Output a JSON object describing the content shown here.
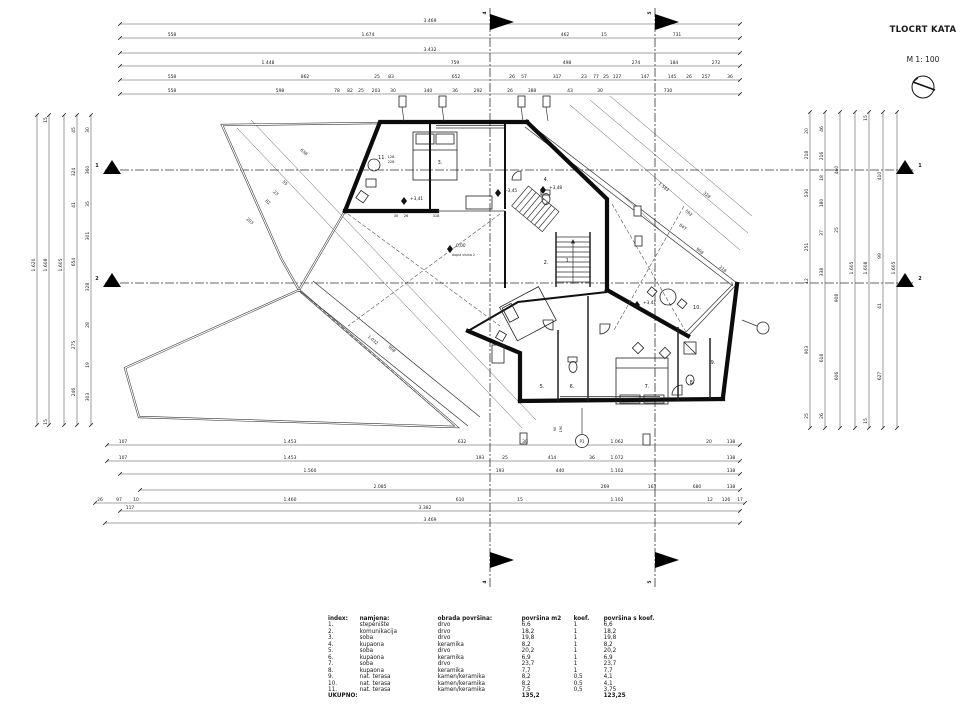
{
  "title_block": {
    "title": "TLOCRT KATA",
    "scale_label": "M 1: 100"
  },
  "sections": {
    "vertical": [
      {
        "label": "4",
        "x": 490
      },
      {
        "label": "5",
        "x": 655
      }
    ],
    "horizontal": [
      {
        "label": "1",
        "y": 170
      },
      {
        "label": "2",
        "y": 283
      }
    ]
  },
  "plan": {
    "room_labels": [
      {
        "t": "1.",
        "x": 568,
        "y": 262
      },
      {
        "t": "2.",
        "x": 546,
        "y": 264
      },
      {
        "t": "3.",
        "x": 440,
        "y": 164
      },
      {
        "t": "4.",
        "x": 546,
        "y": 181
      },
      {
        "t": "5.",
        "x": 542,
        "y": 388
      },
      {
        "t": "6.",
        "x": 572,
        "y": 388
      },
      {
        "t": "7.",
        "x": 647,
        "y": 388
      },
      {
        "t": "8.",
        "x": 692,
        "y": 384
      },
      {
        "t": "9.",
        "x": 713,
        "y": 364
      },
      {
        "t": "10.",
        "x": 697,
        "y": 309
      },
      {
        "t": "11.",
        "x": 382,
        "y": 159
      }
    ],
    "elevations": [
      {
        "t": "0,00",
        "x": 456,
        "y": 247,
        "dx": 450,
        "dy": 249
      },
      {
        "t": "+3,41",
        "x": 410,
        "y": 200,
        "dx": 404,
        "dy": 201
      },
      {
        "t": "+3,45",
        "x": 504,
        "y": 192,
        "dx": 498,
        "dy": 193
      },
      {
        "t": "+3,48",
        "x": 549,
        "y": 189,
        "dx": 543,
        "dy": 190
      },
      {
        "t": "+3,41",
        "x": 643,
        "y": 304,
        "dx": 637,
        "dy": 305
      }
    ],
    "notes": [
      {
        "t": "dupla visina 2",
        "x": 452,
        "y": 256
      }
    ],
    "tags": [
      {
        "t": "P1",
        "x": 582,
        "y": 443
      }
    ],
    "inline_dims": [
      {
        "t": "30",
        "x": 396,
        "y": 217
      },
      {
        "t": "26",
        "x": 406,
        "y": 217
      },
      {
        "t": "318",
        "x": 436,
        "y": 217
      },
      {
        "t": "128",
        "x": 391,
        "y": 158
      },
      {
        "t": "228",
        "x": 391,
        "y": 163
      },
      {
        "t": "90",
        "x": 556,
        "y": 429,
        "r": -90
      },
      {
        "t": "190",
        "x": 562,
        "y": 429,
        "r": -90
      }
    ]
  },
  "dimensions": {
    "top": [
      {
        "y": 24,
        "labels": [
          {
            "t": "3.469",
            "x": 430
          }
        ]
      },
      {
        "y": 38,
        "labels": [
          {
            "t": "558",
            "x": 172
          },
          {
            "t": "1.674",
            "x": 368
          },
          {
            "t": "462",
            "x": 565
          },
          {
            "t": "15",
            "x": 604
          },
          {
            "t": "731",
            "x": 677
          }
        ]
      },
      {
        "y": 53,
        "labels": [
          {
            "t": "3.432",
            "x": 430
          }
        ]
      },
      {
        "y": 66,
        "labels": [
          {
            "t": "1.448",
            "x": 268
          },
          {
            "t": "759",
            "x": 455
          },
          {
            "t": "498",
            "x": 567
          },
          {
            "t": "274",
            "x": 636
          },
          {
            "t": "184",
            "x": 674
          },
          {
            "t": "272",
            "x": 716
          }
        ]
      },
      {
        "y": 80,
        "labels": [
          {
            "t": "558",
            "x": 172
          },
          {
            "t": "862",
            "x": 305
          },
          {
            "t": "25",
            "x": 377
          },
          {
            "t": "83",
            "x": 391
          },
          {
            "t": "652",
            "x": 456
          },
          {
            "t": "26",
            "x": 512
          },
          {
            "t": "57",
            "x": 524
          },
          {
            "t": "317",
            "x": 557
          },
          {
            "t": "23",
            "x": 584
          },
          {
            "t": "77",
            "x": 596
          },
          {
            "t": "25",
            "x": 606
          },
          {
            "t": "127",
            "x": 617
          },
          {
            "t": "147",
            "x": 645
          },
          {
            "t": "145",
            "x": 672
          },
          {
            "t": "26",
            "x": 689
          },
          {
            "t": "257",
            "x": 706
          },
          {
            "t": "36",
            "x": 730
          }
        ]
      },
      {
        "y": 94,
        "labels": [
          {
            "t": "558",
            "x": 172
          },
          {
            "t": "598",
            "x": 280
          },
          {
            "t": "78",
            "x": 337
          },
          {
            "t": "82",
            "x": 350
          },
          {
            "t": "25",
            "x": 361
          },
          {
            "t": "203",
            "x": 376
          },
          {
            "t": "30",
            "x": 393
          },
          {
            "t": "340",
            "x": 428
          },
          {
            "t": "36",
            "x": 455
          },
          {
            "t": "292",
            "x": 478
          },
          {
            "t": "26",
            "x": 510
          },
          {
            "t": "388",
            "x": 532
          },
          {
            "t": "43",
            "x": 570
          },
          {
            "t": "30",
            "x": 600
          },
          {
            "t": "730",
            "x": 668
          }
        ]
      }
    ],
    "bottom": [
      {
        "y": 445,
        "labels": [
          {
            "t": "107",
            "x": 123
          },
          {
            "t": "1.453",
            "x": 290
          },
          {
            "t": "632",
            "x": 462
          },
          {
            "t": "30",
            "x": 525
          },
          {
            "t": "1.062",
            "x": 617
          },
          {
            "t": "20",
            "x": 709
          },
          {
            "t": "138",
            "x": 731
          }
        ]
      },
      {
        "y": 461,
        "labels": [
          {
            "t": "107",
            "x": 123
          },
          {
            "t": "1.453",
            "x": 290
          },
          {
            "t": "193",
            "x": 480
          },
          {
            "t": "25",
            "x": 505
          },
          {
            "t": "414",
            "x": 552
          },
          {
            "t": "36",
            "x": 592
          },
          {
            "t": "1.072",
            "x": 617
          },
          {
            "t": "138",
            "x": 731
          }
        ]
      },
      {
        "y": 474,
        "labels": [
          {
            "t": "1.560",
            "x": 310
          },
          {
            "t": "193",
            "x": 500
          },
          {
            "t": "440",
            "x": 560
          },
          {
            "t": "1.102",
            "x": 617
          },
          {
            "t": "138",
            "x": 731
          }
        ]
      },
      {
        "y": 490,
        "labels": [
          {
            "t": "2.085",
            "x": 380
          },
          {
            "t": "269",
            "x": 605
          },
          {
            "t": "163",
            "x": 652
          },
          {
            "t": "680",
            "x": 697
          },
          {
            "t": "138",
            "x": 731
          }
        ]
      },
      {
        "y": 503,
        "labels": [
          {
            "t": "26",
            "x": 100
          },
          {
            "t": "97",
            "x": 119
          },
          {
            "t": "10",
            "x": 136
          },
          {
            "t": "1.460",
            "x": 290
          },
          {
            "t": "610",
            "x": 460
          },
          {
            "t": "15",
            "x": 520
          },
          {
            "t": "1.102",
            "x": 617
          },
          {
            "t": "12",
            "x": 710
          },
          {
            "t": "126",
            "x": 726
          },
          {
            "t": "17",
            "x": 740
          }
        ]
      },
      {
        "y": 511,
        "labels": [
          {
            "t": "117",
            "x": 130
          },
          {
            "t": "3.382",
            "x": 425
          }
        ]
      },
      {
        "y": 523,
        "labels": [
          {
            "t": "3.469",
            "x": 430
          }
        ]
      }
    ],
    "left": [
      {
        "x": 37,
        "labels": [
          {
            "t": "1.620",
            "y": 265
          }
        ]
      },
      {
        "x": 49,
        "labels": [
          {
            "t": "15",
            "y": 120
          },
          {
            "t": "1.608",
            "y": 265
          },
          {
            "t": "15",
            "y": 422
          }
        ]
      },
      {
        "x": 64,
        "labels": [
          {
            "t": "1.605",
            "y": 265
          }
        ]
      },
      {
        "x": 77,
        "labels": [
          {
            "t": "45",
            "y": 130
          },
          {
            "t": "324",
            "y": 172
          },
          {
            "t": "41",
            "y": 205
          },
          {
            "t": "654",
            "y": 262
          },
          {
            "t": "275",
            "y": 345
          },
          {
            "t": "246",
            "y": 392
          }
        ]
      },
      {
        "x": 91,
        "labels": [
          {
            "t": "30",
            "y": 130
          },
          {
            "t": "360",
            "y": 170
          },
          {
            "t": "35",
            "y": 204
          },
          {
            "t": "301",
            "y": 236
          },
          {
            "t": "328",
            "y": 287
          },
          {
            "t": "28",
            "y": 325
          },
          {
            "t": "19",
            "y": 365
          },
          {
            "t": "303",
            "y": 397
          }
        ]
      }
    ],
    "right": [
      {
        "x": 810,
        "labels": [
          {
            "t": "20",
            "y": 131
          },
          {
            "t": "218",
            "y": 155
          },
          {
            "t": "530",
            "y": 193
          },
          {
            "t": "251",
            "y": 247
          },
          {
            "t": "12",
            "y": 281
          },
          {
            "t": "903",
            "y": 350
          },
          {
            "t": "25",
            "y": 416
          }
        ]
      },
      {
        "x": 825,
        "labels": [
          {
            "t": "46",
            "y": 129
          },
          {
            "t": "216",
            "y": 156
          },
          {
            "t": "18",
            "y": 178
          },
          {
            "t": "180",
            "y": 203
          },
          {
            "t": "37",
            "y": 233
          },
          {
            "t": "338",
            "y": 272
          },
          {
            "t": "618",
            "y": 358
          },
          {
            "t": "26",
            "y": 416
          }
        ]
      },
      {
        "x": 840,
        "labels": [
          {
            "t": "460",
            "y": 170
          },
          {
            "t": "25",
            "y": 230
          },
          {
            "t": "908",
            "y": 298
          },
          {
            "t": "606",
            "y": 376
          }
        ]
      },
      {
        "x": 855,
        "labels": [
          {
            "t": "1.605",
            "y": 268
          }
        ]
      },
      {
        "x": 869,
        "labels": [
          {
            "t": "15",
            "y": 118
          },
          {
            "t": "1.608",
            "y": 268
          },
          {
            "t": "15",
            "y": 421
          }
        ]
      },
      {
        "x": 883,
        "labels": [
          {
            "t": "410",
            "y": 176
          },
          {
            "t": "99",
            "y": 256
          },
          {
            "t": "41",
            "y": 306
          },
          {
            "t": "627",
            "y": 376
          }
        ]
      },
      {
        "x": 897,
        "labels": [
          {
            "t": "1.605",
            "y": 268
          }
        ]
      }
    ],
    "diagonal": [
      {
        "t": "638",
        "x": 303,
        "y": 153,
        "r": 42
      },
      {
        "t": "55",
        "x": 284,
        "y": 184,
        "r": 42
      },
      {
        "t": "23",
        "x": 275,
        "y": 194,
        "r": 42
      },
      {
        "t": "82",
        "x": 267,
        "y": 203,
        "r": 42
      },
      {
        "t": "203",
        "x": 249,
        "y": 222,
        "r": 42
      },
      {
        "t": "1.032",
        "x": 372,
        "y": 341,
        "r": 41
      },
      {
        "t": "908",
        "x": 391,
        "y": 350,
        "r": 41
      },
      {
        "t": "1.583",
        "x": 663,
        "y": 188,
        "r": 38
      },
      {
        "t": "328",
        "x": 706,
        "y": 196,
        "r": 38
      },
      {
        "t": "562",
        "x": 688,
        "y": 214,
        "r": 38
      },
      {
        "t": "847",
        "x": 682,
        "y": 228,
        "r": 38
      },
      {
        "t": "908",
        "x": 699,
        "y": 252,
        "r": 38
      },
      {
        "t": "218",
        "x": 722,
        "y": 270,
        "r": 38
      }
    ]
  },
  "legend": {
    "headers": [
      "index:",
      "namjena:",
      "obrada površina:",
      "površina m2",
      "koef.",
      "površina s koef."
    ],
    "rows": [
      [
        "1.",
        "stepenište",
        "drvo",
        "6,6",
        "1",
        "6,6"
      ],
      [
        "2.",
        "komunikacija",
        "drvo",
        "18,2",
        "1",
        "18,2"
      ],
      [
        "3.",
        "soba",
        "drvo",
        "19,8",
        "1",
        "19,8"
      ],
      [
        "4.",
        "kupaona",
        "keramika",
        "8,2",
        "1",
        "8,2"
      ],
      [
        "5.",
        "soba",
        "drvo",
        "20,2",
        "1",
        "20,2"
      ],
      [
        "6.",
        "kupaona",
        "keramika",
        "6,9",
        "1",
        "6,9"
      ],
      [
        "7.",
        "soba",
        "drvo",
        "23,7",
        "1",
        "23,7"
      ],
      [
        "8.",
        "kupaona",
        "keramika",
        "7,7",
        "1",
        "7,7"
      ],
      [
        "9.",
        "nat. terasa",
        "kamen/keramika",
        "8,2",
        "0,5",
        "4,1"
      ],
      [
        "10.",
        "nat. terasa",
        "kamen/keramika",
        "8,2",
        "0,5",
        "4,1"
      ],
      [
        "11.",
        "nat. terasa",
        "kamen/keramika",
        "7,5",
        "0,5",
        "3,75"
      ]
    ],
    "total_label": "UKUPNO:",
    "total_m2": "135,2",
    "total_koef": "123,25"
  }
}
